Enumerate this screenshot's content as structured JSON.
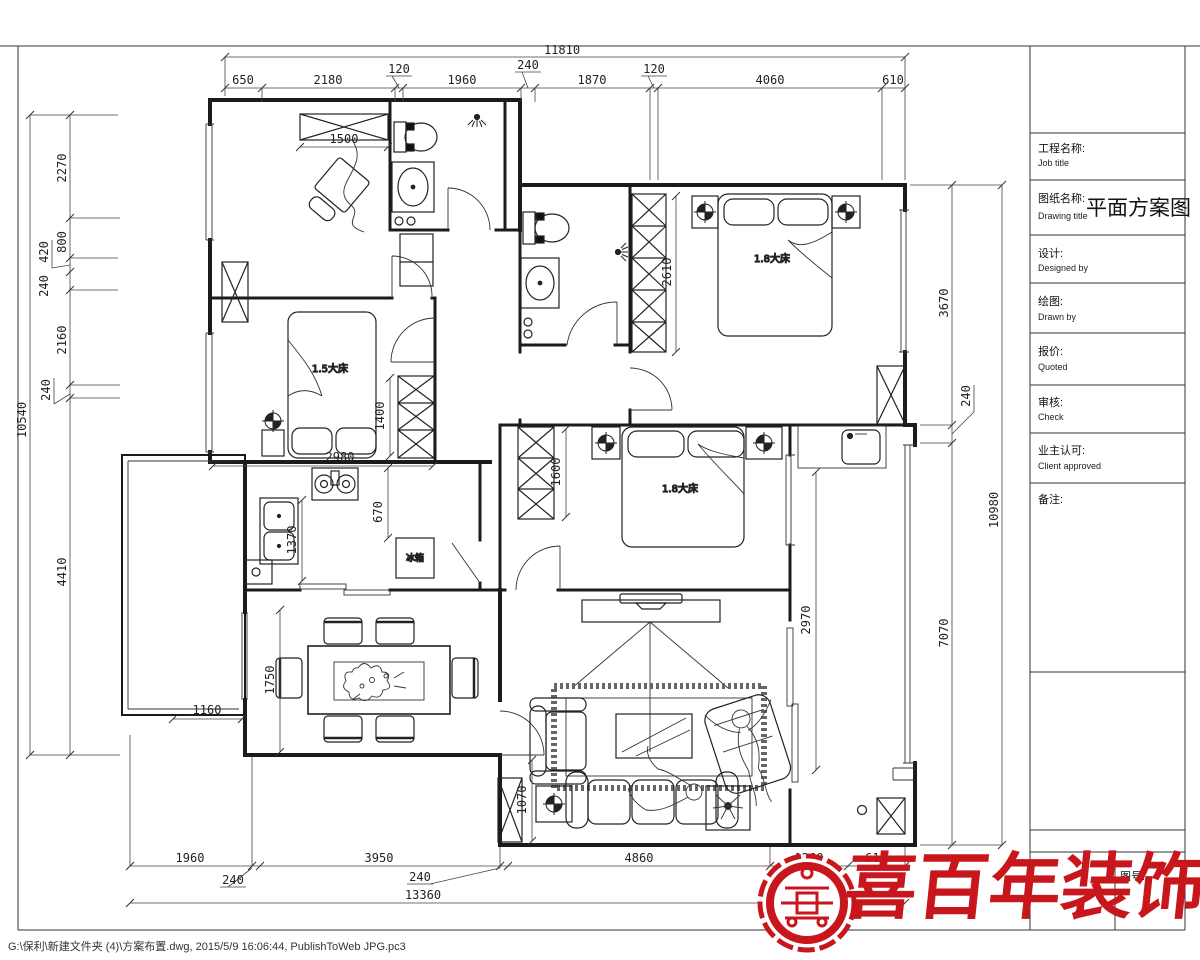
{
  "frame": {
    "footer_text": "G:\\保利\\新建文件夹 (4)\\方案布置.dwg, 2015/5/9 16:06:44, PublishToWeb JPG.pc3"
  },
  "title_block": {
    "drawing_title": "平面方案图",
    "drawing_no_label": "图号:",
    "rows": [
      {
        "cn": "工程名称:",
        "en": "Job title"
      },
      {
        "cn": "图纸名称:",
        "en": "Drawing title"
      },
      {
        "cn": "设计:",
        "en": "Designed by"
      },
      {
        "cn": "绘图:",
        "en": "Drawn by"
      },
      {
        "cn": "报价:",
        "en": "Quoted"
      },
      {
        "cn": "审核:",
        "en": "Check"
      },
      {
        "cn": "业主认可:",
        "en": "Client approved"
      },
      {
        "cn": "备注:",
        "en": ""
      }
    ]
  },
  "logo": {
    "text": "喜百年装饰",
    "accent_color": "#c8161d"
  },
  "rooms": {
    "bed_master": "1.8大床",
    "bed_second": "1.8大床",
    "bed_third": "1.5大床",
    "fridge": "冰箱"
  },
  "dims": {
    "top": {
      "overall": "11810",
      "segments": [
        "650",
        "2180",
        "120",
        "1960",
        "240",
        "1870",
        "120",
        "4060",
        "610"
      ]
    },
    "left": {
      "overall": "10540",
      "segments": [
        "2270",
        "800",
        "420",
        "240",
        "2160",
        "240",
        "4410"
      ]
    },
    "right": {
      "overall": "10980",
      "segments": [
        "3670",
        "240",
        "7070"
      ]
    },
    "bottom": {
      "overall": "13360",
      "segments": [
        "1960",
        "240",
        "3950",
        "240",
        "4860",
        "1260",
        "610"
      ]
    },
    "interior": {
      "study_wardrobe": "1500",
      "bed1_wardrobe": "2610",
      "bed3_wardrobe": "1400",
      "bed3_width": "2980",
      "bed2_wardrobe": "1600",
      "kitchen_depth": "1370",
      "kitchen_col": "670",
      "dining_height": "1750",
      "balcony_left": "1160",
      "living_side": "1070",
      "balcony_right": "2970"
    }
  }
}
